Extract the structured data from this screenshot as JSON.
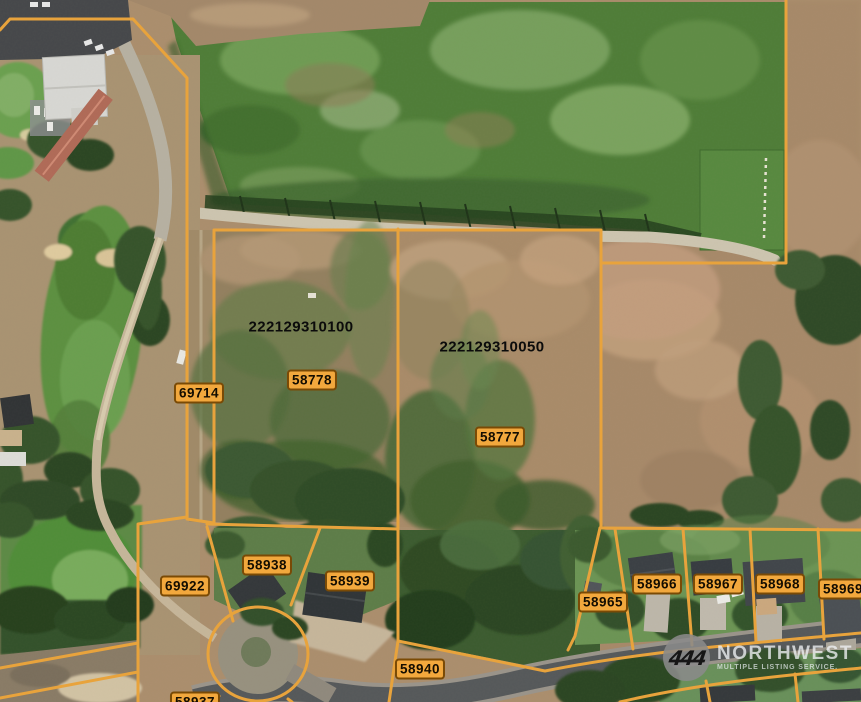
{
  "map": {
    "colors": {
      "parcel_line": "#E8A33C",
      "label_bg": "#F2A83D",
      "label_border": "#7A4A05",
      "label_text": "#140D00"
    },
    "parcel_ids": [
      {
        "text": "222129310100",
        "x": 301,
        "y": 327
      },
      {
        "text": "222129310050",
        "x": 492,
        "y": 347
      }
    ],
    "lot_labels": [
      {
        "text": "58778",
        "x": 312,
        "y": 380
      },
      {
        "text": "58777",
        "x": 500,
        "y": 437
      },
      {
        "text": "69714",
        "x": 199,
        "y": 393
      },
      {
        "text": "69922",
        "x": 185,
        "y": 586
      },
      {
        "text": "58938",
        "x": 267,
        "y": 565
      },
      {
        "text": "58939",
        "x": 350,
        "y": 581
      },
      {
        "text": "58940",
        "x": 420,
        "y": 669
      },
      {
        "text": "58937",
        "x": 195,
        "y": 702
      },
      {
        "text": "58965",
        "x": 603,
        "y": 602
      },
      {
        "text": "58966",
        "x": 657,
        "y": 584
      },
      {
        "text": "58967",
        "x": 718,
        "y": 584
      },
      {
        "text": "58968",
        "x": 780,
        "y": 584
      },
      {
        "text": "58969",
        "x": 843,
        "y": 589
      }
    ],
    "watermark": {
      "logo_glyph": "444",
      "name": "NORTHWEST",
      "tagline": "MULTIPLE LISTING SERVICE."
    }
  }
}
